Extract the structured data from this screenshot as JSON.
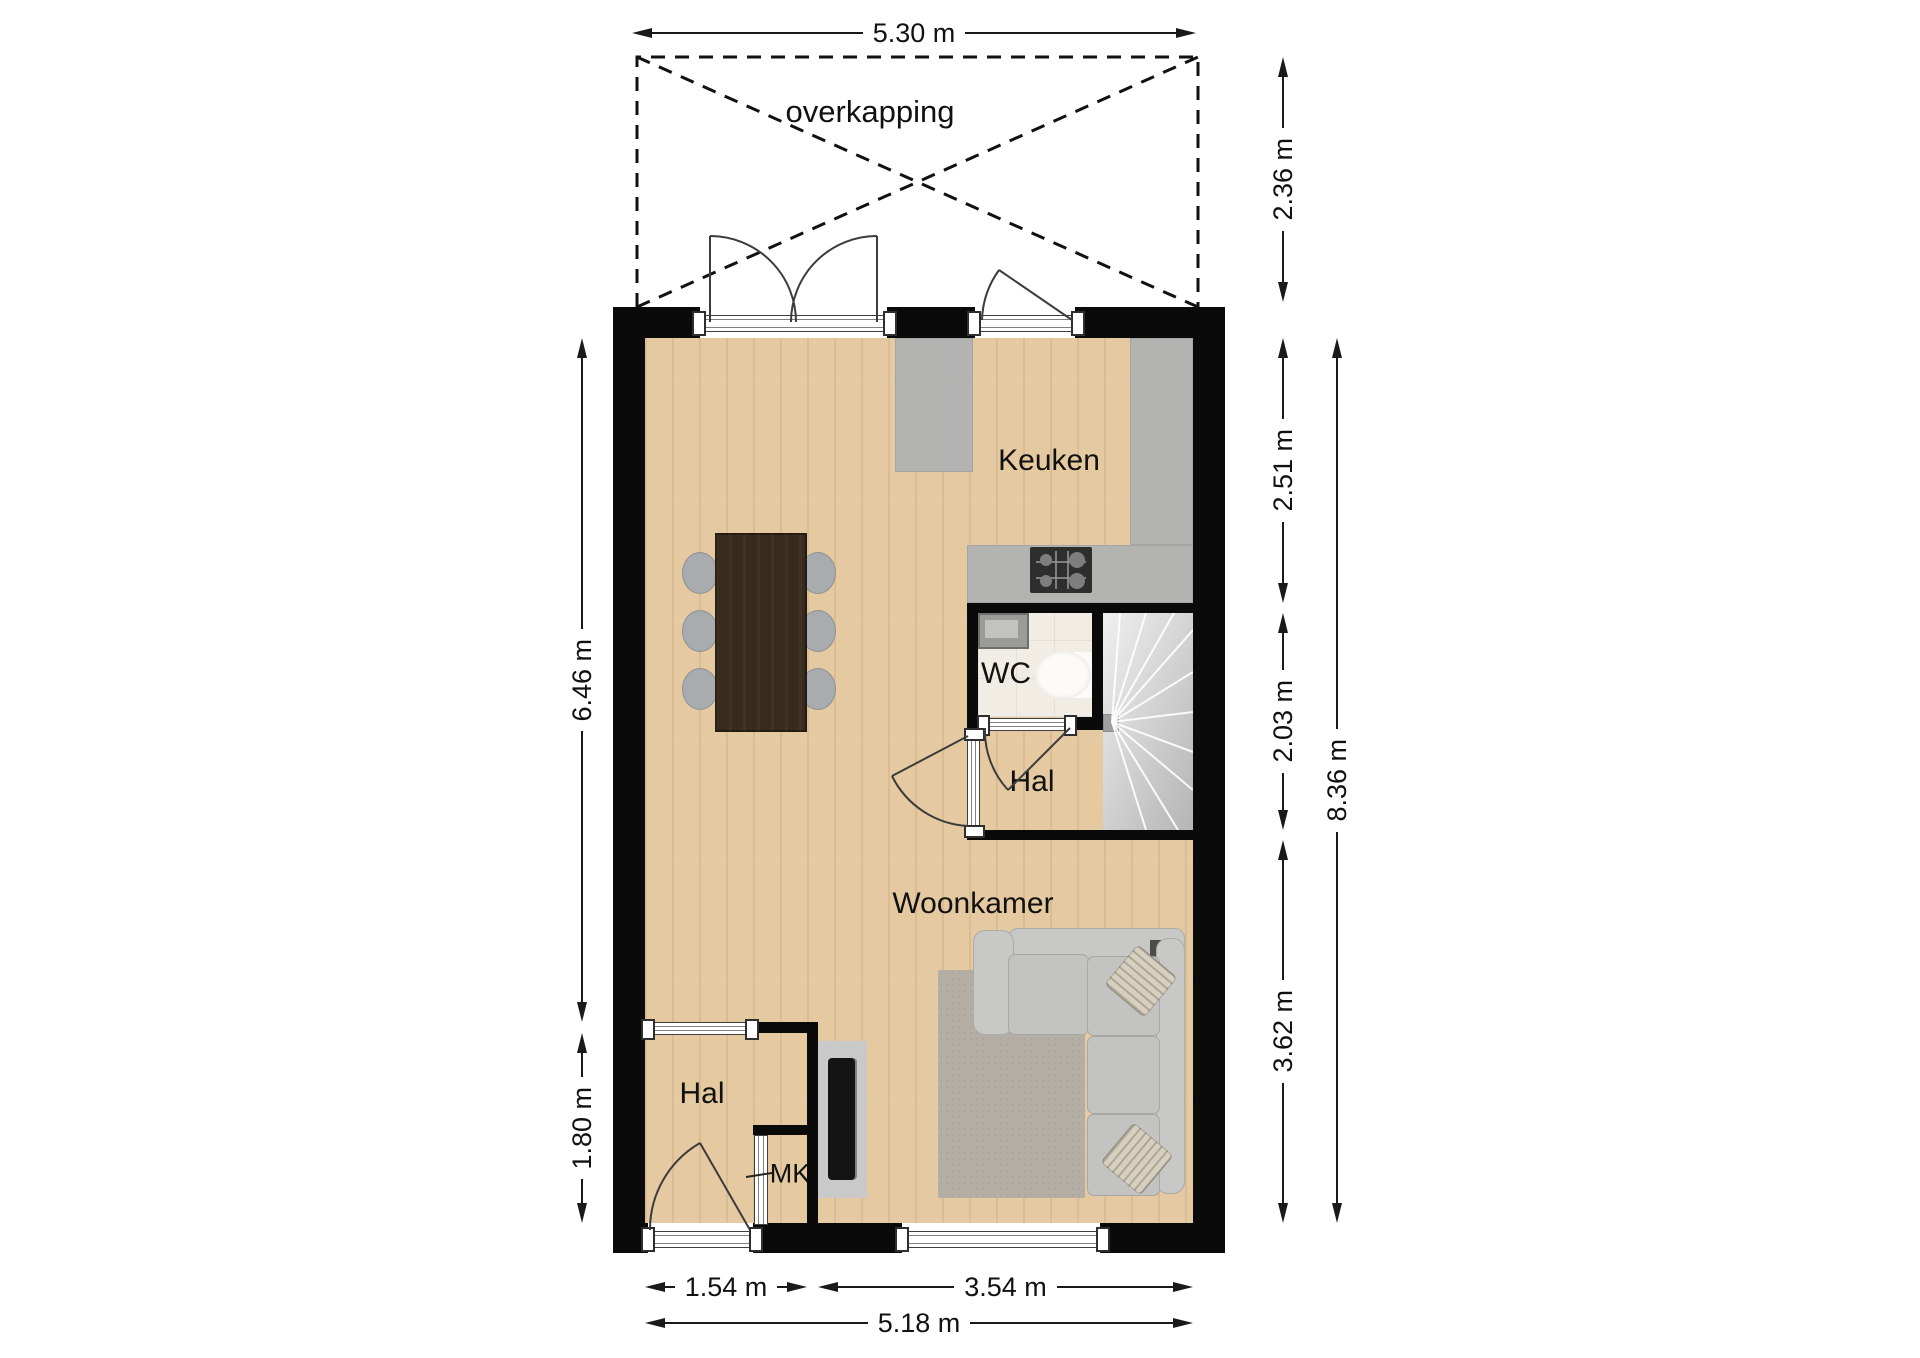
{
  "labels": {
    "overkapping": "overkapping",
    "keuken": "Keuken",
    "wc": "WC",
    "hal_upper": "Hal",
    "hal_lower": "Hal",
    "woonkamer": "Woonkamer",
    "mk": "MK"
  },
  "dimensions": {
    "overkapping_width": "5.30 m",
    "overkapping_depth": "2.36 m",
    "kitchen_depth": "2.51 m",
    "hall_depth": "2.03 m",
    "livingroom_depth": "3.62 m",
    "interior_total_depth": "8.36 m",
    "left_upper_depth": "6.46 m",
    "left_lower_depth": "1.80 m",
    "hall_width": "1.54 m",
    "livingroom_width": "3.54 m",
    "interior_total_width": "5.18 m"
  },
  "colors": {
    "wall": "#0a0a0a",
    "wood_floor": "#e5c9a0",
    "counter": "#b3b3b1",
    "wc_floor": "#f1ede5",
    "stairs": "#d8d8d8",
    "sofa": "#c8c8c6",
    "rug": "#b5aea4",
    "table": "#382b1d",
    "dimension_line": "#1a1a1a"
  }
}
